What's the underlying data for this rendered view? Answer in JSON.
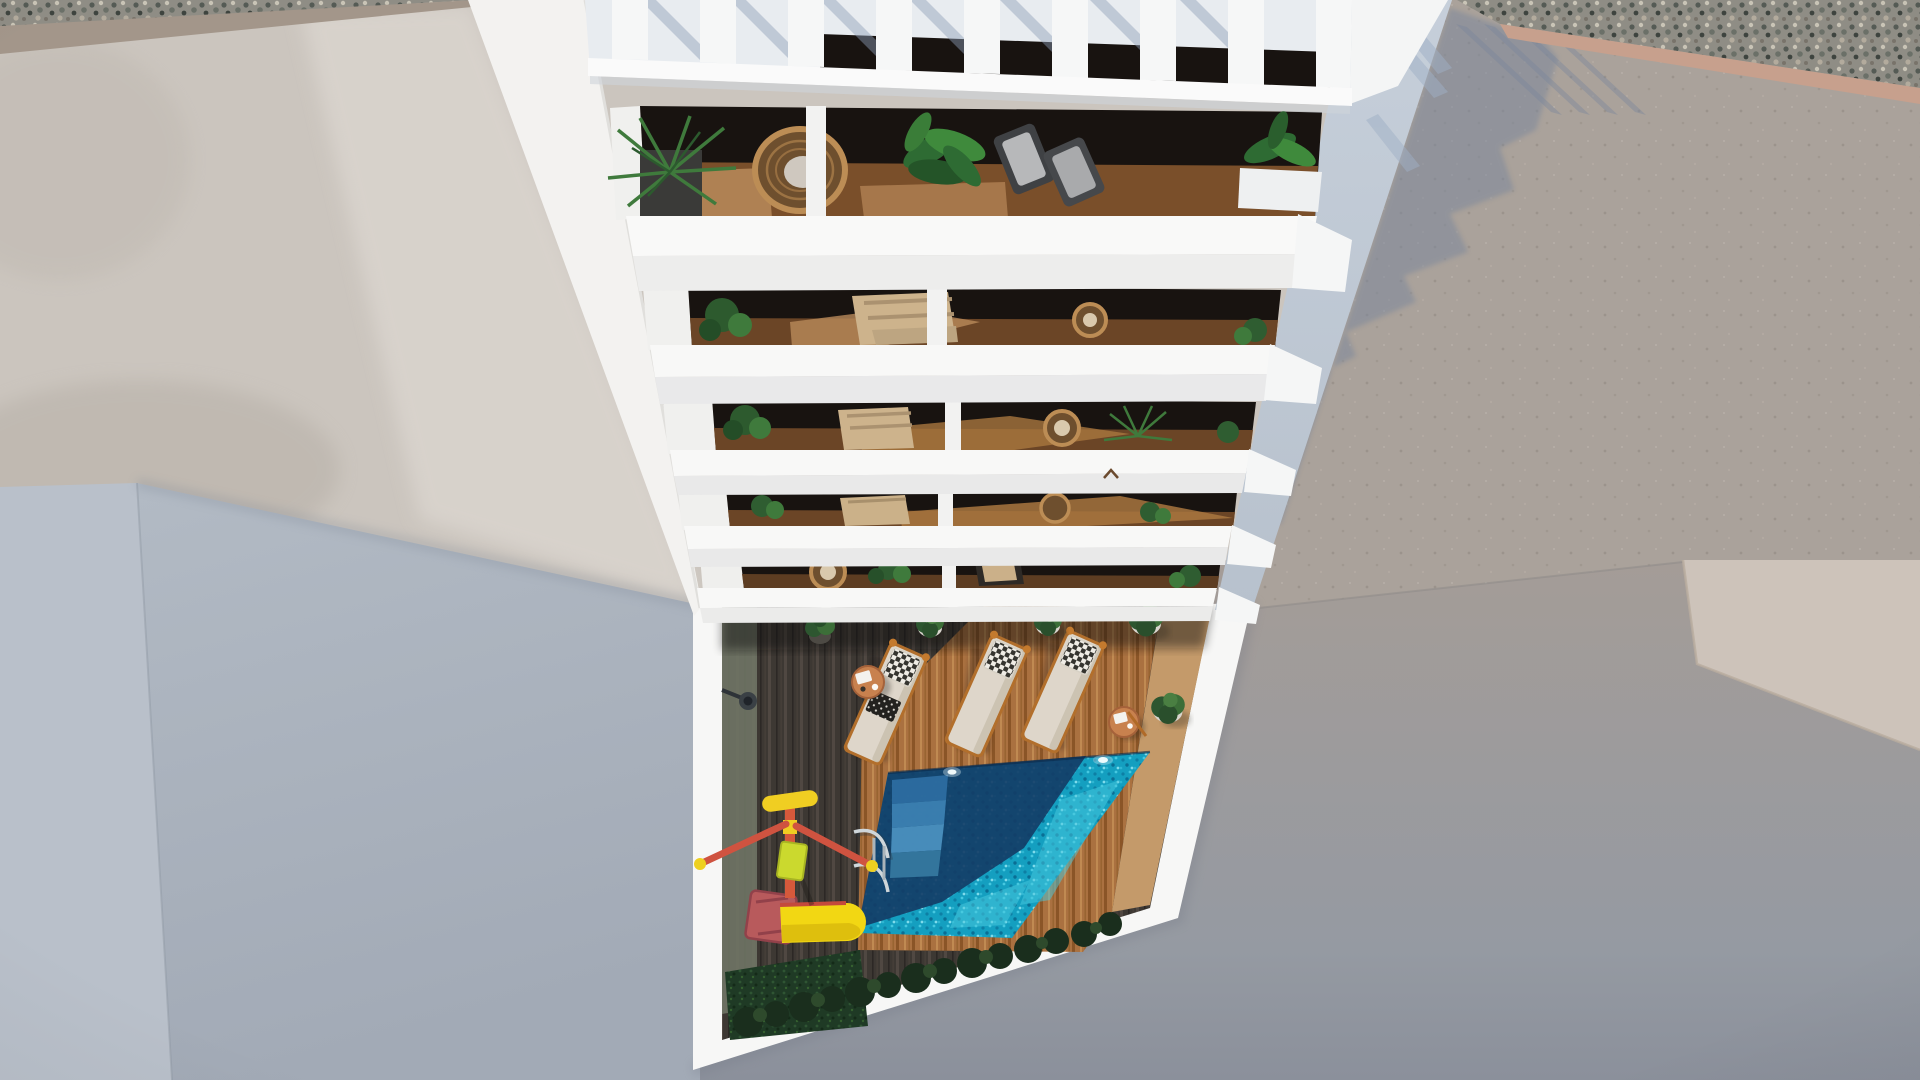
{
  "scene": {
    "type": "architectural-render",
    "view": "top-down aerial exterior render",
    "description": "Aerial view looking straight down the facade of a white multi-storey apartment building with stacked balconies and a rooftop pergola; at ground level a courtyard with wooden deck, turquoise swimming pool with steps and ladder, three sun loungers, side tables, potted plants, a yellow children's slide and play unit, hedges, surrounded by concrete streets, a neighbouring gravel-edged roof and large shaded wall planes.",
    "objects": {
      "balcony_floors": 5,
      "pergola_slats": 9,
      "sun_loungers": 3,
      "side_tables": 2,
      "potted_plants": 5,
      "pool": "rectangular, partly in building shadow, with corner steps and chrome ladder",
      "playground": "yellow slide with red frame and red-armed spinner post",
      "other": [
        "wall lamp",
        "hedge row",
        "grass strip",
        "small bird on parapet"
      ]
    },
    "palette": {
      "concrete": "#cbc5be",
      "concreteBright": "#e2ddd7",
      "tanBand": "#a3968a",
      "gravel": "#8f8d85",
      "pinkBand": "#c7a08d",
      "roof": "#aaa29b",
      "roofShadow": "#7b879b",
      "canyonLeft": "#b9c0ca",
      "canyonRight": "#a2aab6",
      "taupeTop": "#a49c97",
      "taupeBottom": "#8b909b",
      "lightWall": "#cdc3ba",
      "buildingWhite": "#f7f7f6",
      "parapetFace": "#ececeb",
      "sideWall": "#c6cfda",
      "glazing": "#181310",
      "balconyDeck": "#7a4f2a",
      "deckShade": "#3d3833",
      "deckSun": "#aa7140",
      "poolTurquoise": "#149fc0",
      "poolNavy": "#133b65",
      "grass": "#1f3a25",
      "bush": "#1d3320",
      "slideYellow": "#f2d713",
      "slideRed": "#b85a5c",
      "playRed": "#d6593b",
      "playYellow": "#f0ce22",
      "loungerBody": "#ded6ca",
      "wicker": "#bc8d55",
      "potWhite": "#d9d5ce",
      "tableTop": "#c8814e",
      "ladderChrome": "#cfd6da"
    }
  }
}
